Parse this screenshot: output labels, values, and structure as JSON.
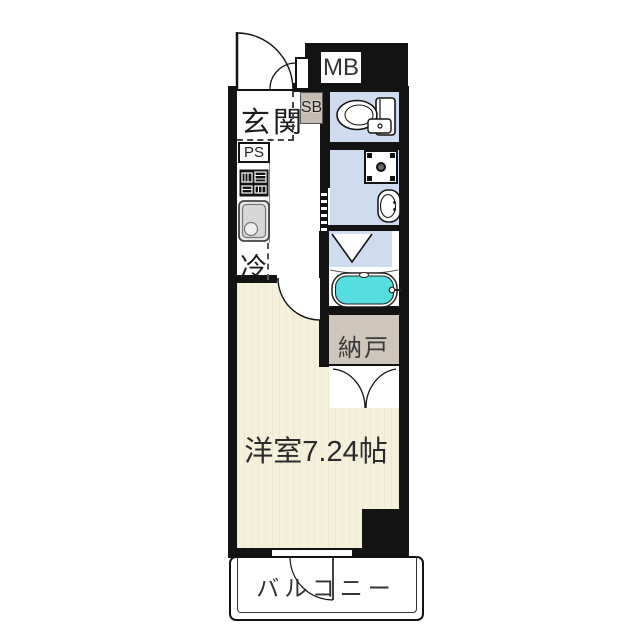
{
  "floor_plan": {
    "labels": {
      "entrance": "玄関",
      "shoe_box": "SB",
      "pipe_space": "PS",
      "meter_box": "MB",
      "refrigerator": "冷",
      "storage_room": "納戸",
      "western_room": "洋室7.24帖",
      "balcony": "バルコニー"
    },
    "rooms": [
      {
        "name": "entrance-hall",
        "label": "玄関"
      },
      {
        "name": "toilet",
        "label": ""
      },
      {
        "name": "washroom",
        "label": ""
      },
      {
        "name": "bathroom",
        "label": ""
      },
      {
        "name": "kitchen",
        "label": ""
      },
      {
        "name": "storage-room",
        "label": "納戸"
      },
      {
        "name": "western-room",
        "label": "洋室7.24帖",
        "size_tatami": "7.24帖"
      },
      {
        "name": "balcony",
        "label": "バルコニー"
      }
    ],
    "colors": {
      "wall": "#131313",
      "room_floor": "#f4f0da",
      "wet_area_floor": "#cfdcf0",
      "storage_floor": "#cec5bb",
      "bathtub_water": "#55dde0",
      "shoe_box_fill": "#c7bcb1"
    },
    "icons": [
      "entrance-door-icon",
      "toilet-icon",
      "washing-machine-icon",
      "washroom-sink-icon",
      "kitchen-stove-icon",
      "kitchen-sink-icon",
      "bathtub-icon",
      "folding-door-icon",
      "sliding-door-icon",
      "room-door-icon",
      "double-door-icon",
      "balcony-door-icon"
    ]
  }
}
